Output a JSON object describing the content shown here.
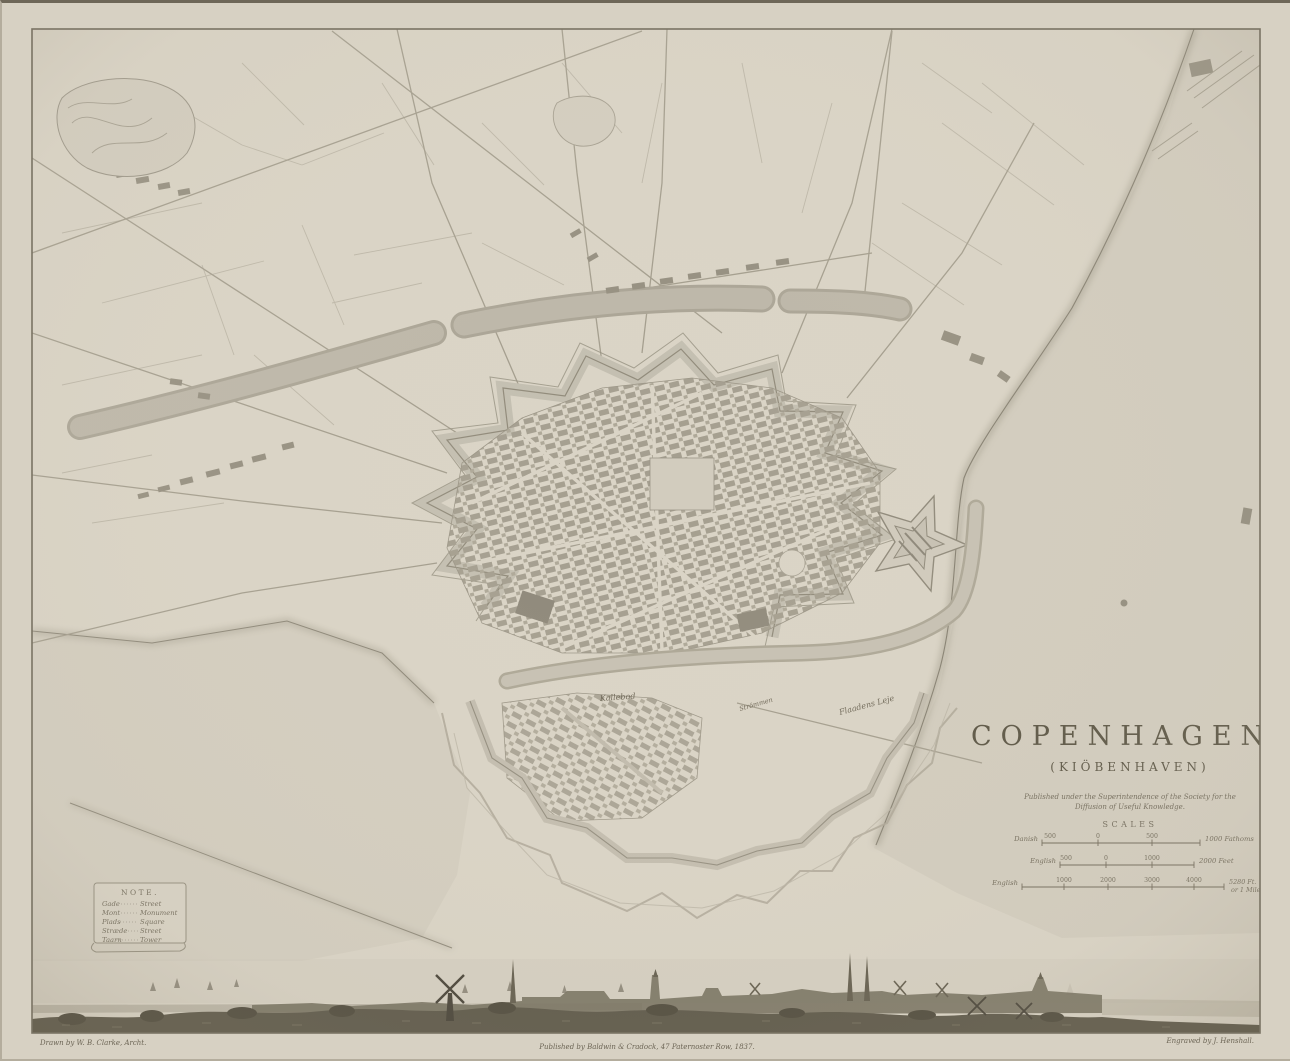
{
  "print": {
    "title": "COPENHAGEN.",
    "subtitle": "(KIÖBENHAVEN)",
    "imprint": {
      "line1": "Published under the Superintendence of the Society for the",
      "line2": "Diffusion of Useful Knowledge."
    },
    "scales": {
      "heading": "SCALES",
      "bar1": {
        "name": "Danish",
        "t1": "500",
        "t2": "0",
        "t3": "500",
        "end": "1000 Fathoms"
      },
      "bar2": {
        "name": "English",
        "t1": "500",
        "t2": "0",
        "t3": "1000",
        "end": "2000 Feet"
      },
      "bar3": {
        "name": "English",
        "t1": "1000",
        "t2": "2000",
        "t3": "3000",
        "t4": "4000",
        "end1": "5280 Ft.",
        "end2": "or 1 Mile"
      }
    },
    "note": {
      "heading": "NOTE.",
      "rows": [
        {
          "term": "Gade",
          "meaning": "Street"
        },
        {
          "term": "Mont",
          "meaning": "Monument"
        },
        {
          "term": "Plads",
          "meaning": "Square"
        },
        {
          "term": "Stræde",
          "meaning": "Street"
        },
        {
          "term": "Taarn",
          "meaning": "Tower"
        }
      ]
    },
    "water_labels": {
      "kallebod": "Kallebod",
      "strommen": "Strömmen",
      "flaadens_leje": "Flaadens Leje"
    },
    "credits": {
      "left": "Drawn by W. B. Clarke, Archt.",
      "center": "Published by Baldwin & Cradock, 47 Paternoster Row, 1837.",
      "right": "Engraved by J. Henshall."
    },
    "colors": {
      "paper": "#d9d3c5",
      "sea": "#d3cdbf",
      "water_band": "#b9b3a5",
      "blocks": "#a39d8e",
      "ink": "#56503f",
      "panorama_dark": "#514c3d"
    }
  }
}
